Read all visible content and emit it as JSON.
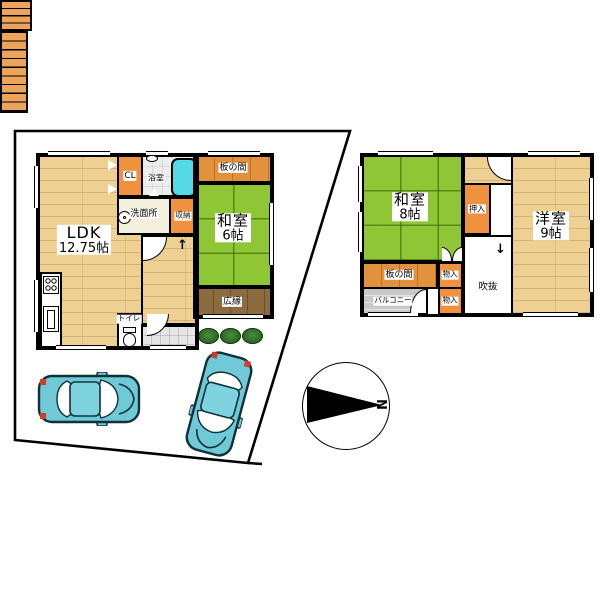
{
  "floor1": {
    "ldk_name": "LDK",
    "ldk_size": "12.75帖",
    "closet": "CL",
    "bath": "浴室",
    "itanoma": "板の間",
    "washroom": "洗面所",
    "storage": "収納",
    "washitsu_name": "和室",
    "washitsu_size": "6帖",
    "hiroen": "広縁",
    "toilet": "トイレ",
    "stairs_arrow": "↑"
  },
  "floor2": {
    "washitsu_name": "和室",
    "washitsu_size": "8帖",
    "oshiire": "押入",
    "yoshitsu_name": "洋室",
    "yoshitsu_size": "9帖",
    "itanoma": "板の間",
    "storage_a": "物入",
    "storage_b": "物入",
    "balcony": "バルコニー",
    "void": "吹抜",
    "stairs_arrow": "↓"
  },
  "compass": {
    "north_label": "N"
  },
  "colors": {
    "tatami_green": "#8FC636",
    "wood_floor": "#EDD092",
    "closet_orange": "#F0913F",
    "itanoma_orange": "#E2913D",
    "hiroen_brown": "#8C6B3E",
    "bathtub_cyan": "#55D8E8",
    "car_teal": "#6FC9D6",
    "balcony_gray": "#C9C9C9",
    "tree_green": "#2F6B28"
  }
}
